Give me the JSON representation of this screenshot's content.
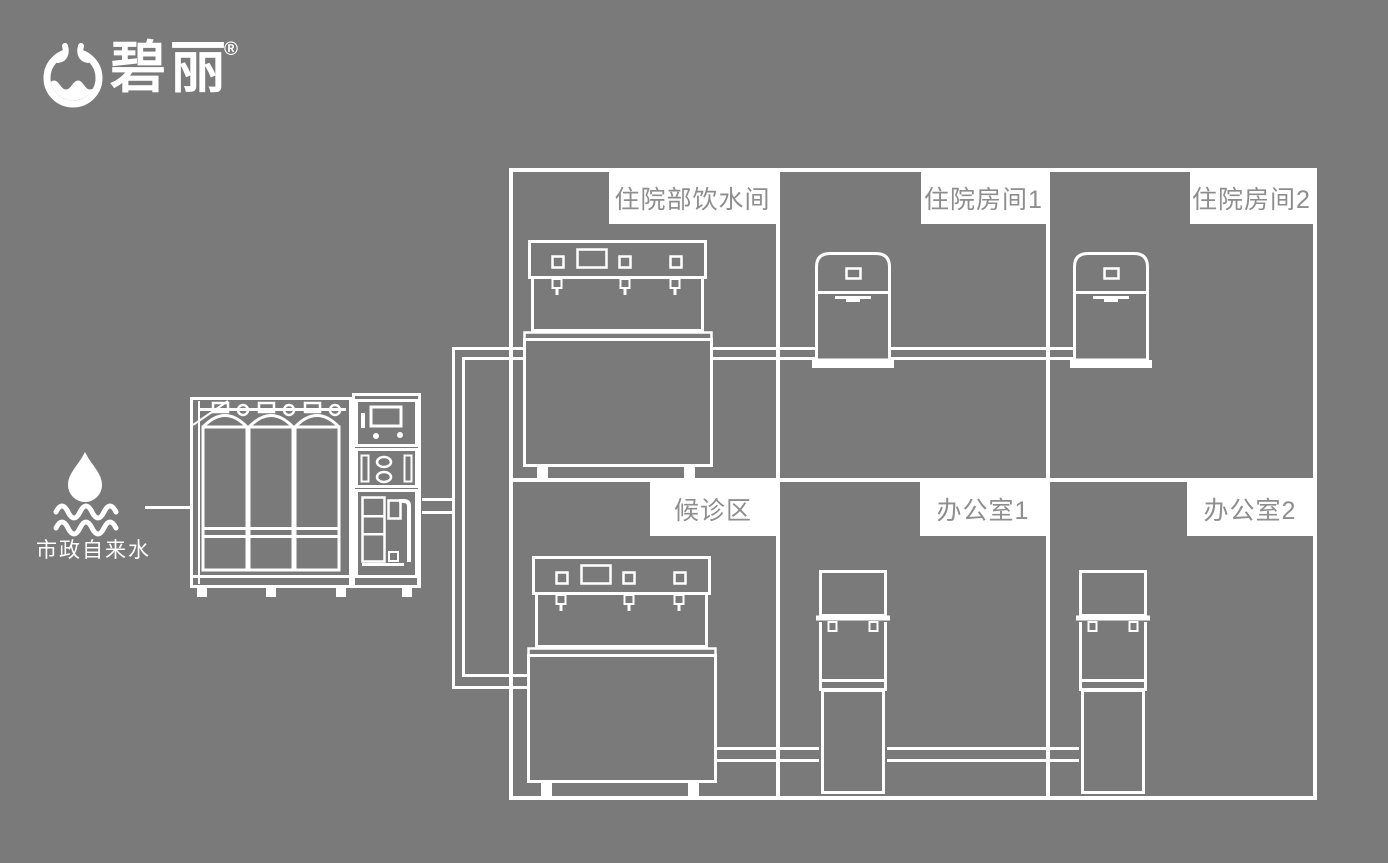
{
  "brand": {
    "name": "碧丽",
    "registered_mark": "®",
    "logo_icon": "water-cup-icon"
  },
  "water_source": {
    "label": "市政自来水",
    "icon": "water-drop-waves-icon"
  },
  "building": {
    "rooms": [
      {
        "label": "住院部饮水间"
      },
      {
        "label": "住院房间1"
      },
      {
        "label": "住院房间2"
      },
      {
        "label": "候诊区"
      },
      {
        "label": "办公室1"
      },
      {
        "label": "办公室2"
      }
    ]
  },
  "colors": {
    "background": "#7a7a7b",
    "line": "#ffffff",
    "label_background": "#ffffff",
    "label_text": "#8e8e8e"
  }
}
